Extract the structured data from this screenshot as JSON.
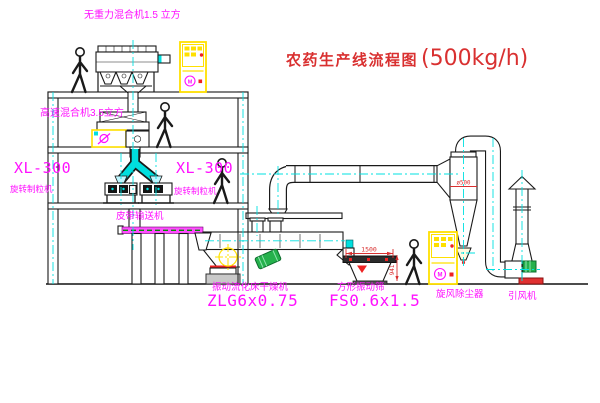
{
  "title": {
    "text": "农药生产线流程图",
    "capacity": "(500kg/h)"
  },
  "labels": {
    "top_mixer": "无重力混合机1.5 立方",
    "second_mixer": "高速混合机3.5立方",
    "granulator_left_model": "XL-300",
    "granulator_left_name": "旋转制粒机",
    "granulator_right_model": "XL-300",
    "granulator_right_name": "旋转制粒机",
    "belt_conveyor": "皮带输送机",
    "dryer_name": "振动流化床干燥机",
    "dryer_model": "ZLG6x0.75",
    "screen_name": "方形振动筛",
    "screen_model": "FS0.6x1.5",
    "cyclone": "旋风除尘器",
    "fan": "引风机",
    "motor_symbol": "M"
  },
  "dimensions": {
    "screen_length": "1500",
    "screen_height": "941",
    "cyclone_diameter": "ø500"
  },
  "colors": {
    "label_magenta": "#ff10ff",
    "annotation_red": "#d93030",
    "centerline_cyan": "#00e0e0",
    "cabinet_yellow": "#ffe000",
    "motor_green": "#25b14c",
    "line_black": "#1a1a1a"
  }
}
